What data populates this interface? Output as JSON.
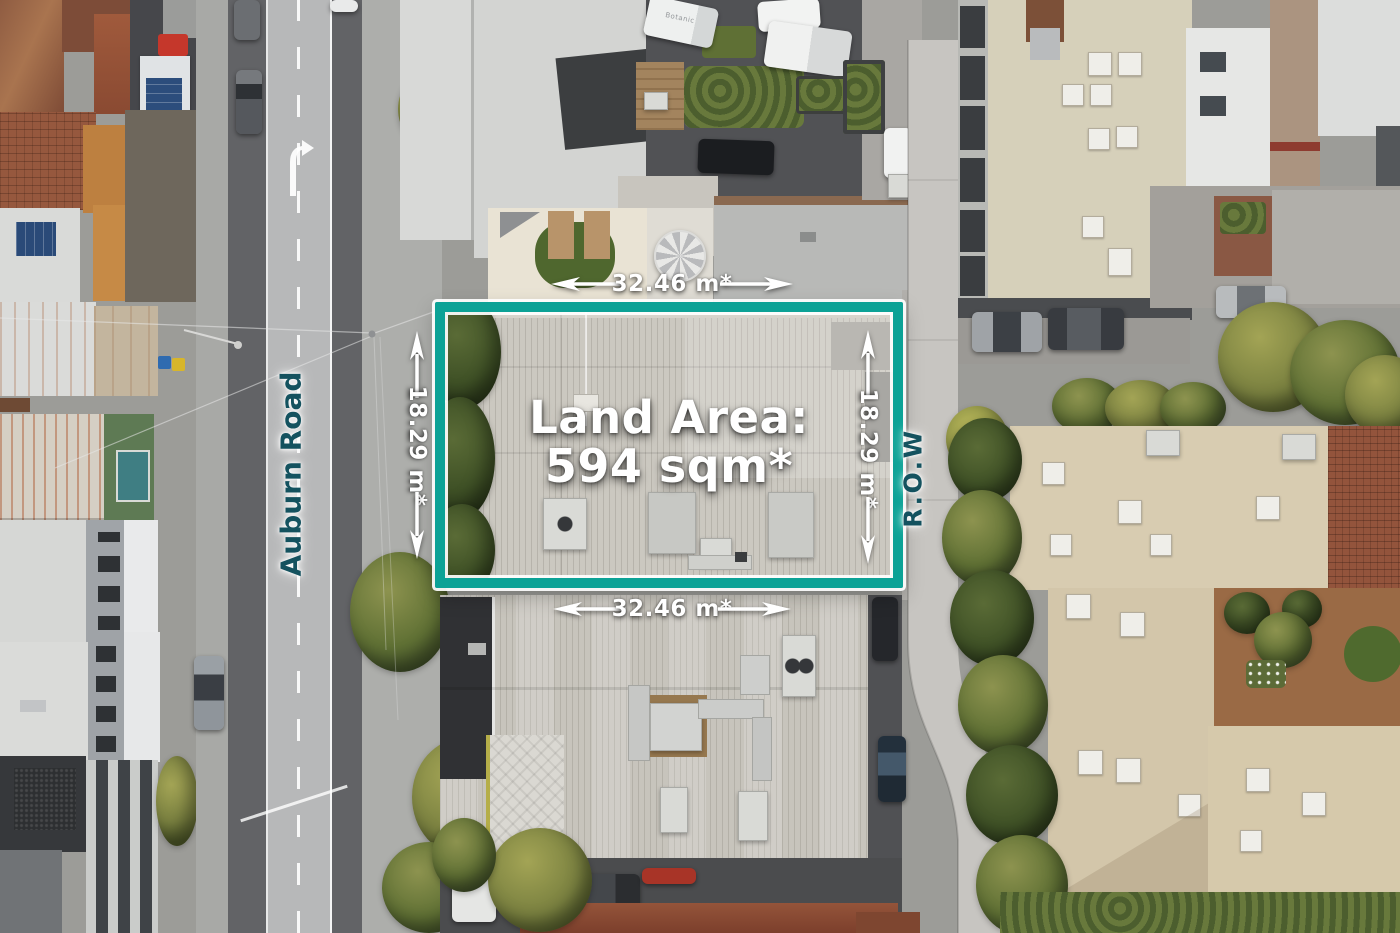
{
  "overlay": {
    "land_area": {
      "title": "Land Area:",
      "value": "594 sqm*"
    },
    "dimensions": {
      "top": "32.46 m*",
      "bottom": "32.46 m*",
      "left": "18.29 m*",
      "right": "18.29 m*"
    },
    "boundary_color": "#0CA296",
    "dimension_text_color": "#FFFFFF"
  },
  "labels": {
    "road_west": "Auburn Road",
    "laneway_east": "R.O.W",
    "road_label_color": "#14525F",
    "van_brand": "Botanic"
  }
}
